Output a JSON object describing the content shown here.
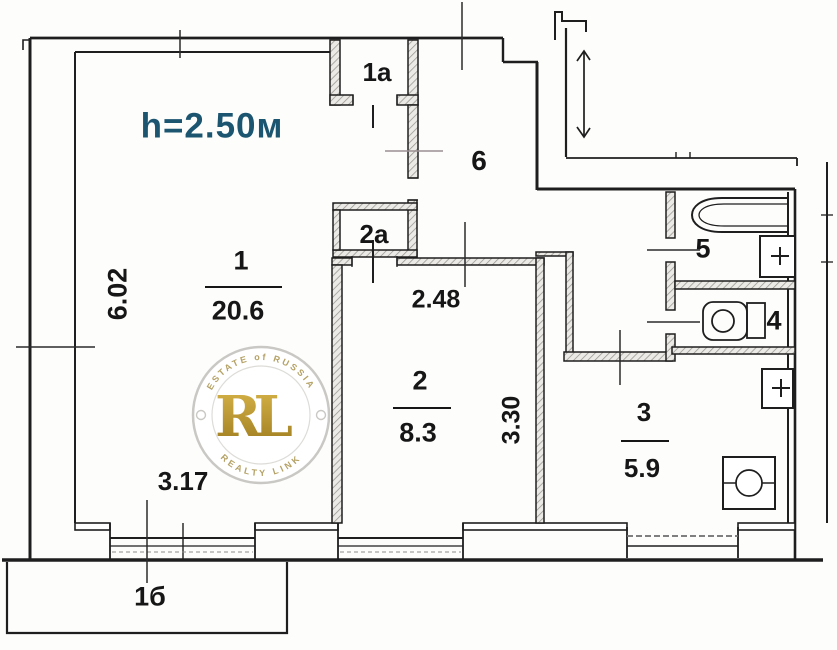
{
  "plan": {
    "ceiling_height": "h=2.50м",
    "rooms": {
      "room1": {
        "number": "1",
        "area": "20.6"
      },
      "room2": {
        "number": "2",
        "area": "8.3"
      },
      "room3": {
        "number": "3",
        "area": "5.9"
      },
      "room4": {
        "number": "4"
      },
      "room5": {
        "number": "5"
      },
      "room6": {
        "number": "6"
      },
      "closet1a": {
        "number": "1a"
      },
      "closet2a": {
        "number": "2a"
      },
      "balcony": {
        "number": "1б"
      }
    },
    "dims": {
      "room1_width": "3.17",
      "room1_depth": "6.02",
      "room2_width": "2.48",
      "room2_depth": "3.30"
    }
  },
  "watermark": {
    "monogram": "RL",
    "arc_top": "ESTATE of RUSSIA",
    "arc_bottom": "REALTY LINK"
  },
  "colors": {
    "ink": "#1e1e1e",
    "height_note": "#1b5570",
    "gold": "#c49a2f"
  }
}
